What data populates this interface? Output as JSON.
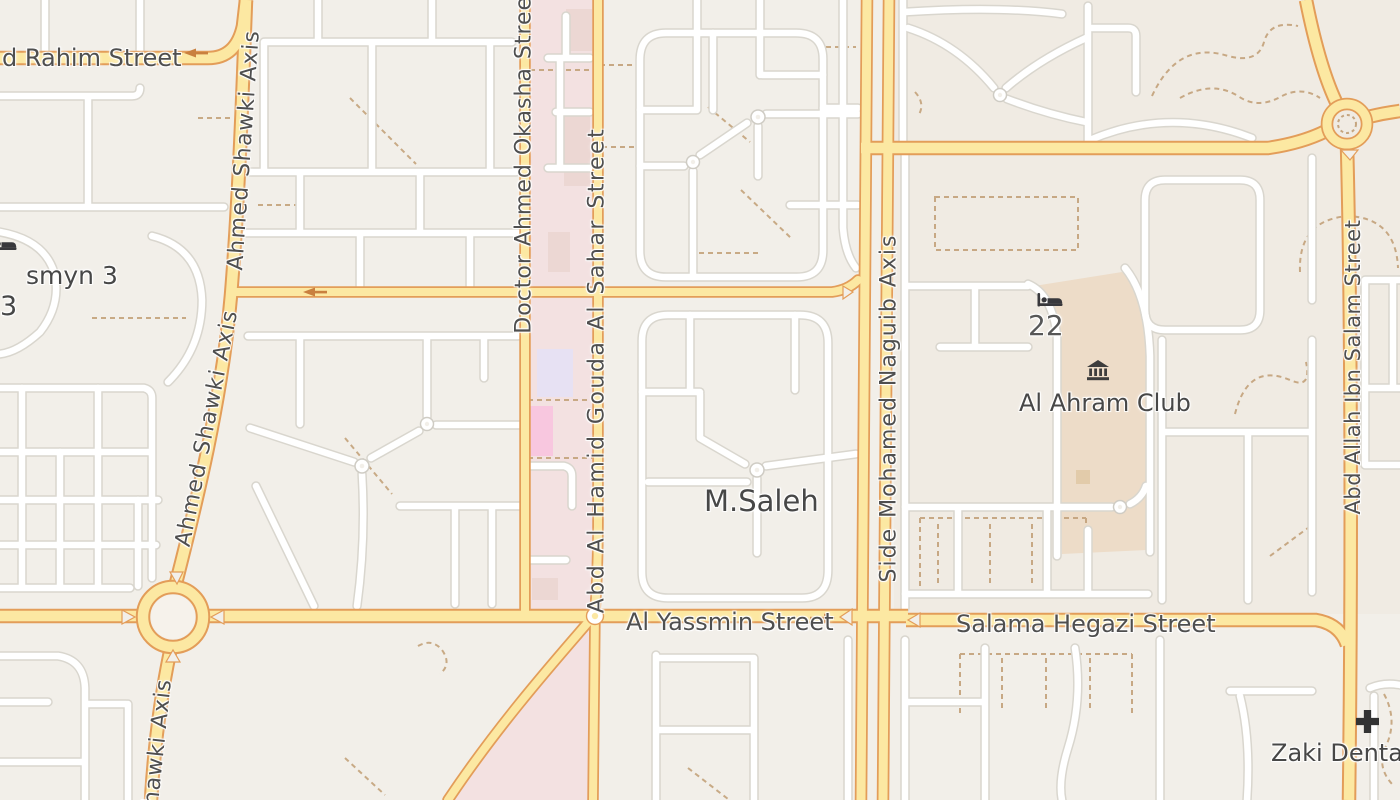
{
  "map_type": "street-map-tile-view",
  "labels": {
    "rahim": "d Rahim Street",
    "shawki_upper": "Ahmed Shawki Axis",
    "shawki_lower": "Ahmed Shawki Axis",
    "shawki_south": "hawki Axis",
    "okasha": "Doctor Ahmed Okasha Street",
    "gouda": "Abd Al Hamid Gouda Al Sahar Street",
    "naguib": "Side Mohamed Naguib Axis",
    "salam": "Abd Allah Ibn Salam Street",
    "yassmin": "Al Yassmin Street",
    "hegazi": "Salama Hegazi Street",
    "msaleh": "M.Saleh",
    "ahram_club": "Al Ahram Club",
    "zaki_dental": "Zaki Dental",
    "hotel_number": "22",
    "yasmyn3": "smyn 3",
    "yasmyn3b": "3"
  },
  "icons": {
    "hotel": "bed-icon",
    "hotel_left_edge": "bed-icon",
    "museum": "museum-icon",
    "dental": "cross-icon"
  },
  "palette": {
    "block_bg": "#f2efe9",
    "block_bg_east": "#f0ebe3",
    "road_primary_fill": "#fce8a2",
    "road_primary_casing": "#e39d59",
    "road_minor_fill": "#ffffff",
    "road_minor_casing": "#d9d6ce",
    "campus_pink": "#f3e1e1",
    "building_pink": "#ecd7d3",
    "building_lavender": "#e7e1f3",
    "building_magenta": "#f8c7df",
    "club_tan": "#eddcc8",
    "footpath_dashed": "#c5a57f",
    "label_color": "#4f4f4f",
    "poi_icon_color": "#38383c",
    "oneway_arrow": "#c9803f"
  }
}
